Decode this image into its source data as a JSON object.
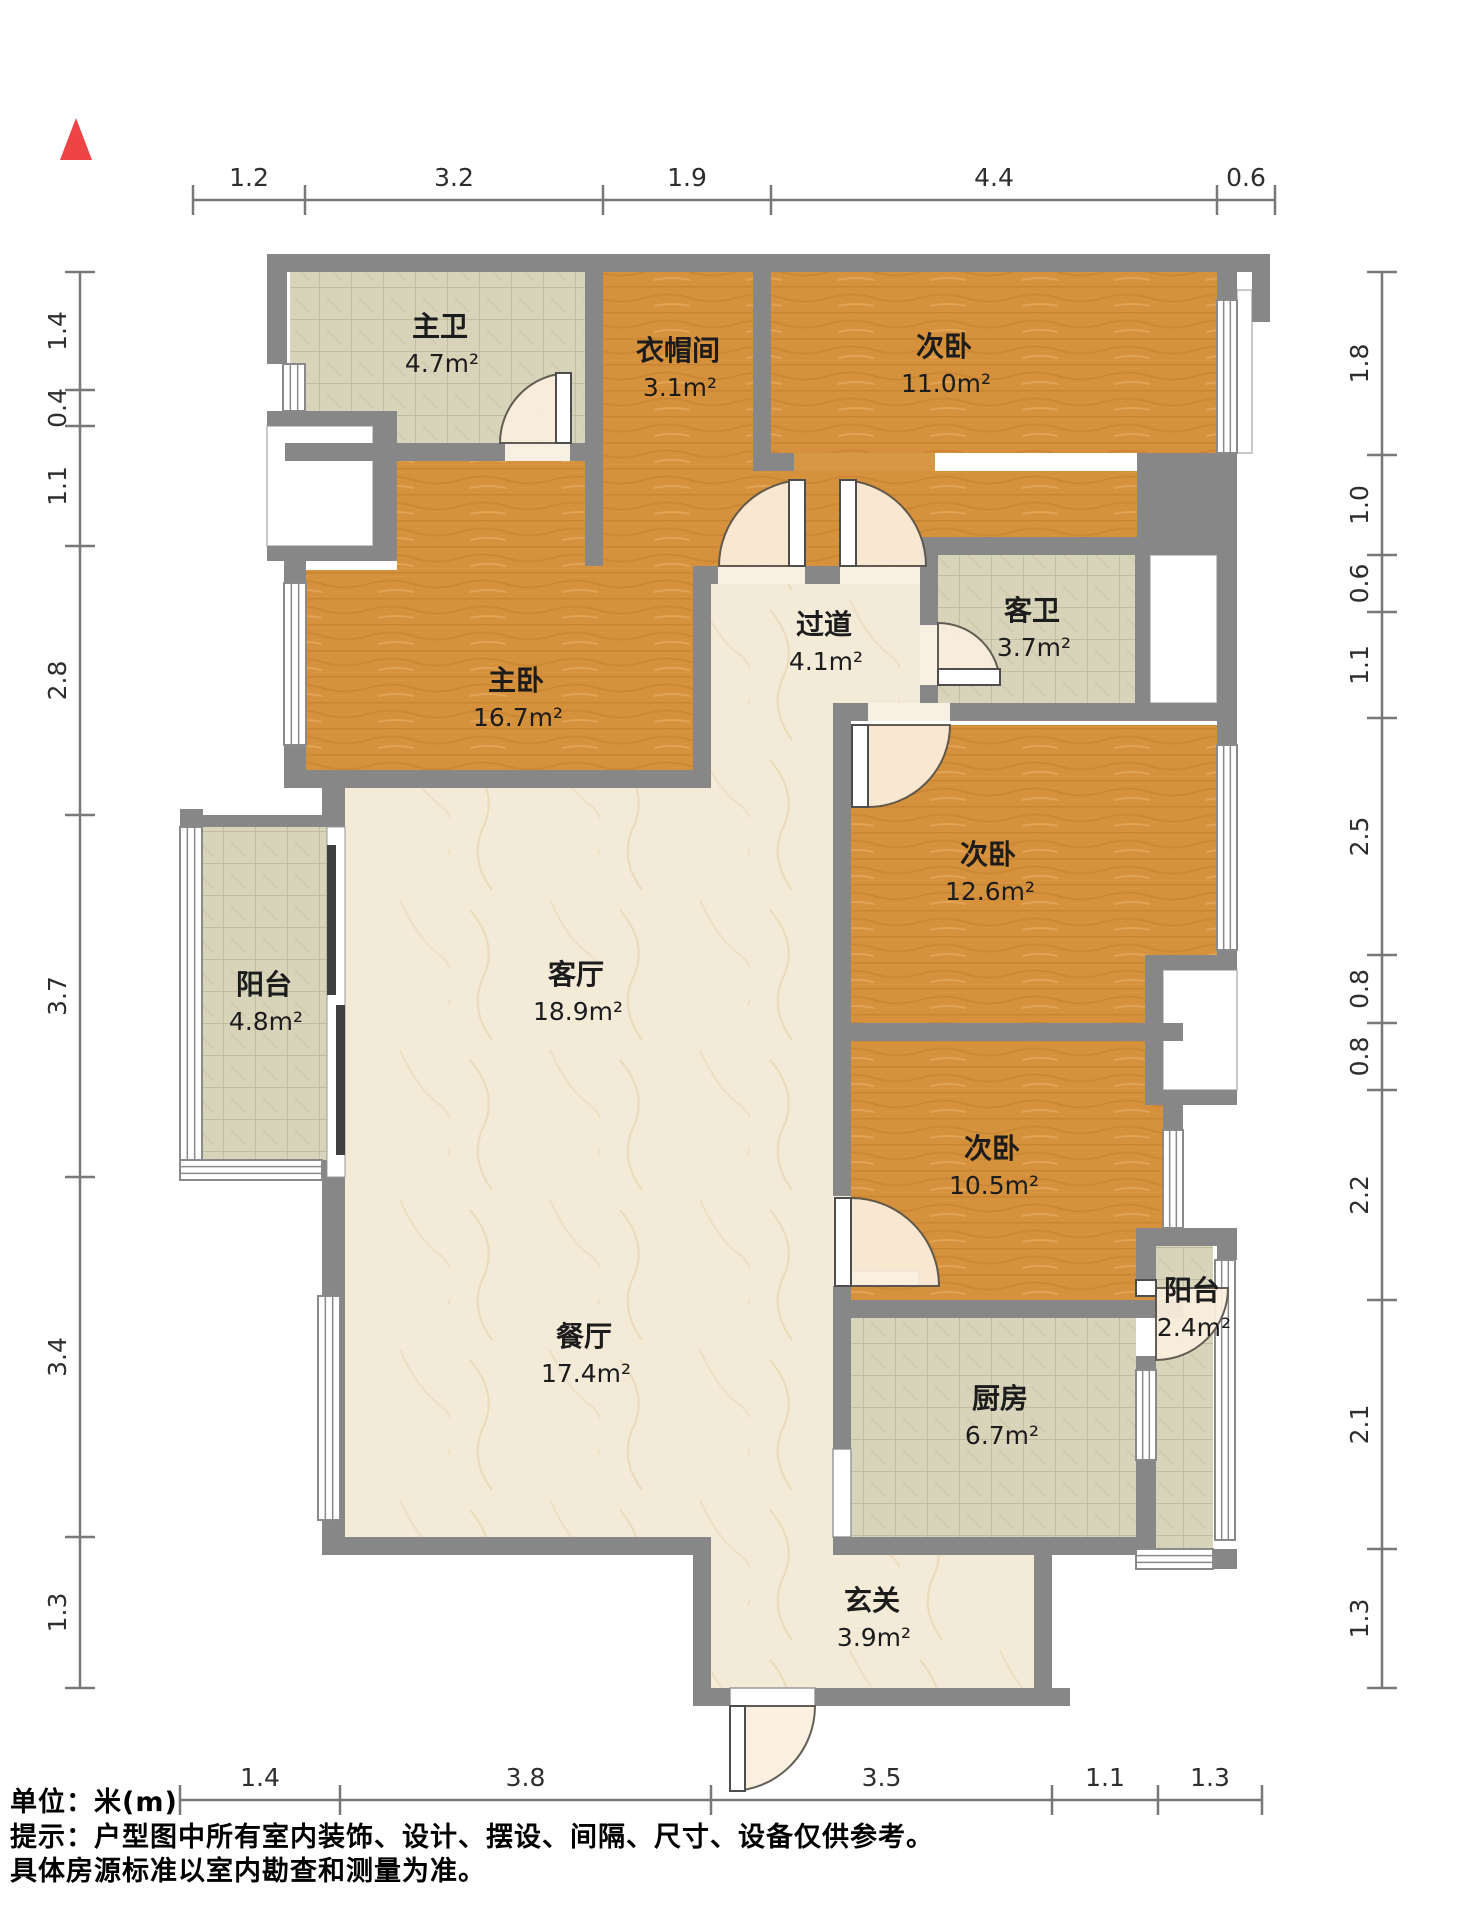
{
  "meta": {
    "footer_lines": [
      "单位：米(m)",
      "提示：户型图中所有室内装饰、设计、摆设、间隔、尺寸、设备仅供参考。",
      "具体房源标准以室内勘查和测量为准。"
    ]
  },
  "palette": {
    "wall": "#878787",
    "wood": "#d6913c",
    "tile": "#d8d4b9",
    "marble": "#f3ead7",
    "swing_fill": "#fbeedd",
    "swing_stroke": "#5a544c",
    "window_stroke": "#8a8a8a",
    "dim_color": "#787878",
    "north_color": "#ee4446"
  },
  "floorplan": {
    "width": 1464,
    "height": 1920,
    "north": {
      "points": "76,118 60,160 92,160"
    },
    "rooms": [
      {
        "name": "主卫",
        "area": "4.7m²",
        "floor": "tile",
        "rects": [
          [
            290,
            272,
            295,
            171
          ]
        ],
        "label": [
          440,
          336
        ]
      },
      {
        "name": "衣帽间",
        "area": "3.1m²",
        "floor": "wood",
        "rects": [
          [
            603,
            272,
            150,
            171
          ]
        ],
        "label": [
          678,
          360
        ]
      },
      {
        "name": "次卧",
        "area": "11.0m²",
        "floor": "wood",
        "rects": [
          [
            771,
            272,
            446,
            181
          ]
        ],
        "label": [
          944,
          356
        ]
      },
      {
        "name": "",
        "area": "",
        "floor": "wood",
        "rects": [
          [
            603,
            443,
            332,
            123
          ],
          [
            935,
            471,
            202,
            66
          ]
        ],
        "label": null
      },
      {
        "name": "主卧",
        "area": "16.7m²",
        "floor": "wood",
        "rects": [
          [
            397,
            461,
            296,
            109
          ],
          [
            306,
            570,
            387,
            200
          ]
        ],
        "label": [
          516,
          690
        ]
      },
      {
        "name": "过道",
        "area": "4.1m²",
        "floor": "marble",
        "rects": [
          [
            711,
            584,
            209,
            119
          ],
          [
            711,
            703,
            122,
            85
          ]
        ],
        "label": [
          824,
          634
        ]
      },
      {
        "name": "客卫",
        "area": "3.7m²",
        "floor": "tile",
        "rects": [
          [
            938,
            555,
            197,
            148
          ]
        ],
        "label": [
          1032,
          620
        ]
      },
      {
        "name": "次卧",
        "area": "12.6m²",
        "floor": "wood",
        "rects": [
          [
            851,
            725,
            366,
            298
          ]
        ],
        "label": [
          988,
          864
        ]
      },
      {
        "name": "次卧",
        "area": "10.5m²",
        "floor": "wood",
        "rects": [
          [
            851,
            1041,
            312,
            259
          ]
        ],
        "label": [
          992,
          1158
        ]
      },
      {
        "name": "阳台",
        "area": "4.8m²",
        "floor": "tile",
        "rects": [
          [
            203,
            827,
            124,
            333
          ]
        ],
        "label": [
          264,
          994
        ]
      },
      {
        "name": "客厅",
        "area": "18.9m²",
        "floor": "marble",
        "rects": [
          [
            345,
            788,
            488,
            749
          ]
        ],
        "label": [
          576,
          984
        ]
      },
      {
        "name": "餐厅",
        "area": "17.4m²",
        "floor": "marble",
        "rects": [],
        "label": [
          584,
          1346
        ]
      },
      {
        "name": "厨房",
        "area": "6.7m²",
        "floor": "tile",
        "rects": [
          [
            851,
            1318,
            285,
            219
          ]
        ],
        "label": [
          1000,
          1408
        ]
      },
      {
        "name": "阳台",
        "area": "2.4m²",
        "floor": "tile",
        "rects": [
          [
            1156,
            1246,
            57,
            303
          ]
        ],
        "label": [
          1192,
          1300
        ]
      },
      {
        "name": "玄关",
        "area": "3.9m²",
        "floor": "marble",
        "rects": [
          [
            711,
            1537,
            323,
            151
          ]
        ],
        "label": [
          872,
          1610
        ]
      }
    ],
    "voids": [
      [
        267,
        426,
        106,
        120
      ],
      [
        1237,
        290,
        15,
        163
      ],
      [
        1150,
        555,
        67,
        148
      ],
      [
        1163,
        970,
        74,
        120
      ]
    ],
    "thresholds": [
      {
        "r": [
          505,
          443,
          65,
          18
        ],
        "fill": "#f7f0e3"
      },
      {
        "r": [
          718,
          566,
          87,
          18
        ],
        "fill": "#f7f0e3"
      },
      {
        "r": [
          840,
          566,
          85,
          18
        ],
        "fill": "#f7f0e3"
      },
      {
        "r": [
          920,
          625,
          18,
          60
        ],
        "fill": "#f7f0e3"
      },
      {
        "r": [
          868,
          703,
          82,
          18
        ],
        "fill": "#f7f0e3"
      },
      {
        "r": [
          833,
          1196,
          18,
          90
        ],
        "fill": "#f7f0e3"
      },
      {
        "r": [
          794,
          453,
          141,
          18
        ],
        "fill": "#d79845"
      },
      {
        "r": [
          833,
          1449,
          18,
          88
        ],
        "fill": "#ffffff",
        "stroke": "#9a9a9a"
      },
      {
        "r": [
          730,
          1688,
          85,
          18
        ],
        "fill": "#ffffff",
        "stroke": "#9a9a9a"
      },
      {
        "r": [
          851,
          1271,
          68,
          15
        ],
        "fill": "#ffffff",
        "stroke": "#6b6b6b"
      }
    ],
    "walls": [
      [
        267,
        254,
        1003,
        18
      ],
      [
        1252,
        272,
        18,
        50
      ],
      [
        267,
        254,
        20,
        110
      ],
      [
        267,
        411,
        130,
        15
      ],
      [
        267,
        546,
        130,
        15
      ],
      [
        373,
        411,
        24,
        150
      ],
      [
        284,
        561,
        22,
        227
      ],
      [
        585,
        254,
        18,
        312
      ],
      [
        285,
        443,
        220,
        18
      ],
      [
        570,
        443,
        15,
        18
      ],
      [
        753,
        254,
        18,
        199
      ],
      [
        753,
        453,
        41,
        18
      ],
      [
        1137,
        453,
        100,
        102
      ],
      [
        920,
        537,
        217,
        18
      ],
      [
        693,
        566,
        25,
        18
      ],
      [
        805,
        566,
        35,
        18
      ],
      [
        925,
        566,
        13,
        18
      ],
      [
        693,
        566,
        18,
        222
      ],
      [
        284,
        770,
        427,
        18
      ],
      [
        322,
        788,
        23,
        39
      ],
      [
        180,
        809,
        23,
        18
      ],
      [
        180,
        815,
        165,
        12
      ],
      [
        322,
        1160,
        23,
        22
      ],
      [
        322,
        1182,
        23,
        355
      ],
      [
        322,
        1537,
        389,
        18
      ],
      [
        693,
        1537,
        18,
        169
      ],
      [
        693,
        1688,
        37,
        18
      ],
      [
        815,
        1688,
        255,
        18
      ],
      [
        1034,
        1555,
        18,
        133
      ],
      [
        833,
        1537,
        323,
        18
      ],
      [
        833,
        1300,
        350,
        18
      ],
      [
        833,
        1023,
        350,
        18
      ],
      [
        833,
        703,
        18,
        338
      ],
      [
        833,
        1041,
        18,
        155
      ],
      [
        833,
        1286,
        18,
        14
      ],
      [
        851,
        703,
        17,
        18
      ],
      [
        950,
        703,
        287,
        18
      ],
      [
        920,
        537,
        18,
        88
      ],
      [
        920,
        685,
        18,
        18
      ],
      [
        1135,
        537,
        15,
        184
      ],
      [
        1217,
        272,
        20,
        28
      ],
      [
        1217,
        453,
        20,
        292
      ],
      [
        1217,
        950,
        20,
        20
      ],
      [
        1145,
        955,
        92,
        15
      ],
      [
        1145,
        1090,
        92,
        15
      ],
      [
        1145,
        955,
        18,
        150
      ],
      [
        1163,
        1105,
        20,
        25
      ],
      [
        1136,
        1228,
        101,
        18
      ],
      [
        1136,
        1246,
        20,
        34
      ],
      [
        1136,
        1356,
        20,
        14
      ],
      [
        1136,
        1460,
        20,
        89
      ],
      [
        1213,
        1549,
        24,
        20
      ],
      [
        1217,
        1246,
        20,
        14
      ],
      [
        833,
        1318,
        18,
        131
      ]
    ],
    "windows": [
      {
        "r": [
          283,
          364,
          22,
          47
        ],
        "dir": "v"
      },
      {
        "r": [
          284,
          583,
          22,
          162
        ],
        "dir": "v"
      },
      {
        "r": [
          180,
          827,
          22,
          333
        ],
        "dir": "v"
      },
      {
        "r": [
          180,
          1160,
          142,
          20
        ],
        "dir": "h"
      },
      {
        "r": [
          318,
          1296,
          22,
          224
        ],
        "dir": "v"
      },
      {
        "r": [
          1217,
          300,
          20,
          153
        ],
        "dir": "v"
      },
      {
        "r": [
          1217,
          745,
          20,
          205
        ],
        "dir": "v"
      },
      {
        "r": [
          1163,
          1130,
          20,
          98
        ],
        "dir": "v"
      },
      {
        "r": [
          1215,
          1260,
          20,
          280
        ],
        "dir": "v"
      },
      {
        "r": [
          1136,
          1549,
          77,
          20
        ],
        "dir": "h"
      },
      {
        "r": [
          1136,
          1370,
          20,
          90
        ],
        "dir": "v"
      }
    ],
    "slider": {
      "back": [
        327,
        827,
        18,
        350
      ],
      "panels": [
        [
          327,
          845,
          9,
          150
        ],
        [
          336,
          1005,
          9,
          150
        ]
      ]
    },
    "doors": [
      {
        "c": [
          570,
          443
        ],
        "r": 70,
        "q": "ul",
        "leaf": [
          556,
          373,
          15,
          70
        ]
      },
      {
        "c": [
          805,
          566
        ],
        "r": 86,
        "q": "ul",
        "leaf": [
          789,
          480,
          16,
          86
        ]
      },
      {
        "c": [
          840,
          566
        ],
        "r": 86,
        "q": "ur",
        "leaf": [
          840,
          480,
          16,
          86
        ]
      },
      {
        "c": [
          938,
          685
        ],
        "r": 62,
        "q": "ur",
        "leaf": [
          938,
          669,
          62,
          16
        ]
      },
      {
        "c": [
          868,
          725
        ],
        "r": 82,
        "q": "dr",
        "leaf": [
          852,
          725,
          16,
          82
        ]
      },
      {
        "c": [
          851,
          1286
        ],
        "r": 88,
        "q": "ur",
        "leaf": [
          835,
          1198,
          16,
          88
        ]
      },
      {
        "c": [
          730,
          1706
        ],
        "r": 85,
        "q": "dr",
        "leaf": [
          730,
          1706,
          15,
          85
        ]
      },
      {
        "c": [
          1156,
          1288
        ],
        "r": 72,
        "q": "dr",
        "leaf": [
          1136,
          1280,
          20,
          16
        ]
      }
    ],
    "dims": {
      "top": {
        "type": "h",
        "pos": 200,
        "ticks": [
          193,
          305,
          603,
          771,
          1217,
          1275
        ],
        "values": [
          "1.2",
          "3.2",
          "1.9",
          "4.4",
          "0.6"
        ]
      },
      "bottom": {
        "type": "h",
        "pos": 1800,
        "ticks": [
          180,
          340,
          711,
          1052,
          1158,
          1262
        ],
        "values": [
          "1.4",
          "3.8",
          "3.5",
          "1.1",
          "1.3"
        ]
      },
      "left": {
        "type": "v",
        "pos": 80,
        "ticks": [
          272,
          390,
          426,
          546,
          815,
          1177,
          1537,
          1688
        ],
        "values": [
          "1.4",
          "0.4",
          "1.1",
          "2.8",
          "3.7",
          "3.4",
          "1.3"
        ]
      },
      "right": {
        "type": "v",
        "pos": 1382,
        "ticks": [
          272,
          455,
          555,
          612,
          718,
          955,
          1023,
          1090,
          1300,
          1549,
          1688
        ],
        "values": [
          "1.8",
          "1.0",
          "0.6",
          "1.1",
          "2.5",
          "0.8",
          "0.8",
          "2.2",
          "2.1",
          "1.3"
        ]
      }
    }
  }
}
